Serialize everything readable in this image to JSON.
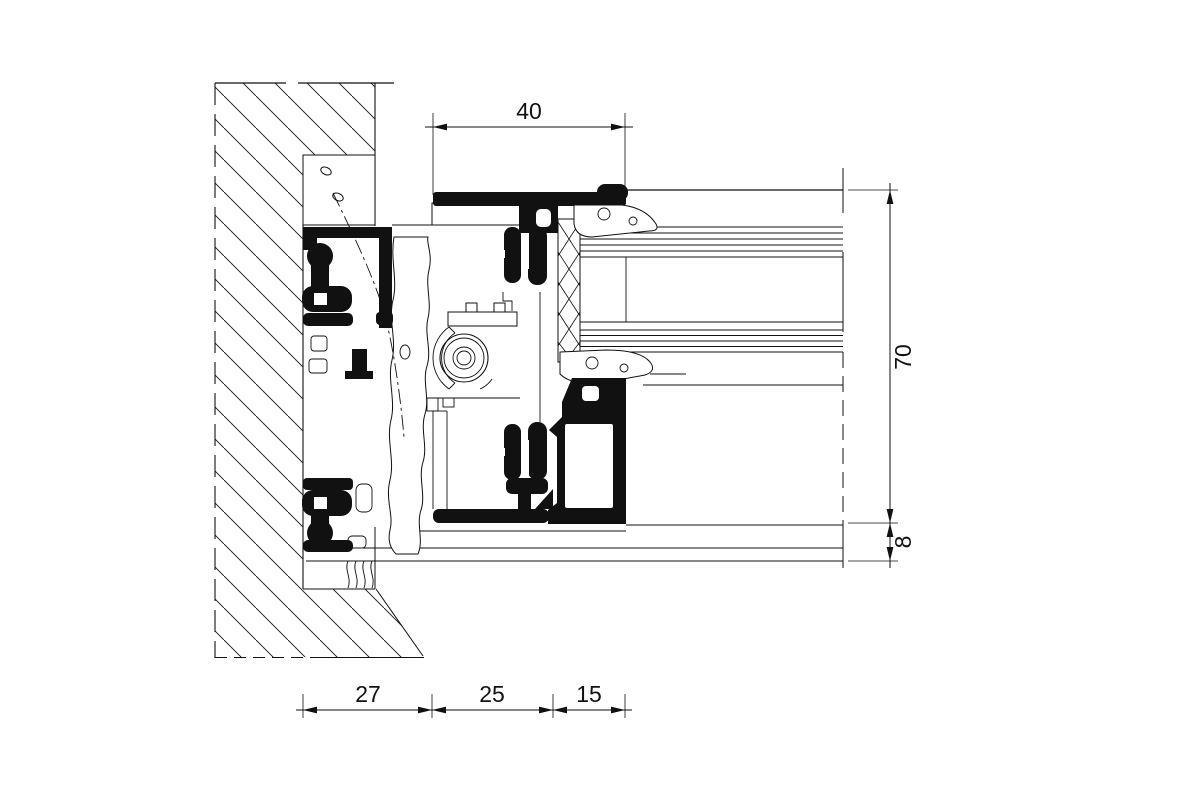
{
  "drawing": {
    "type": "window-frame-installation-section-detail",
    "units": "mm",
    "dimensions": {
      "top_width": "40",
      "frame_height": "70",
      "sill_offset": "8",
      "wall_overlap": "27",
      "frame_depth": "25",
      "bead_width": "15"
    },
    "colors": {
      "line": "#111111",
      "profile_fill": "#000000",
      "background": "#ffffff"
    }
  }
}
